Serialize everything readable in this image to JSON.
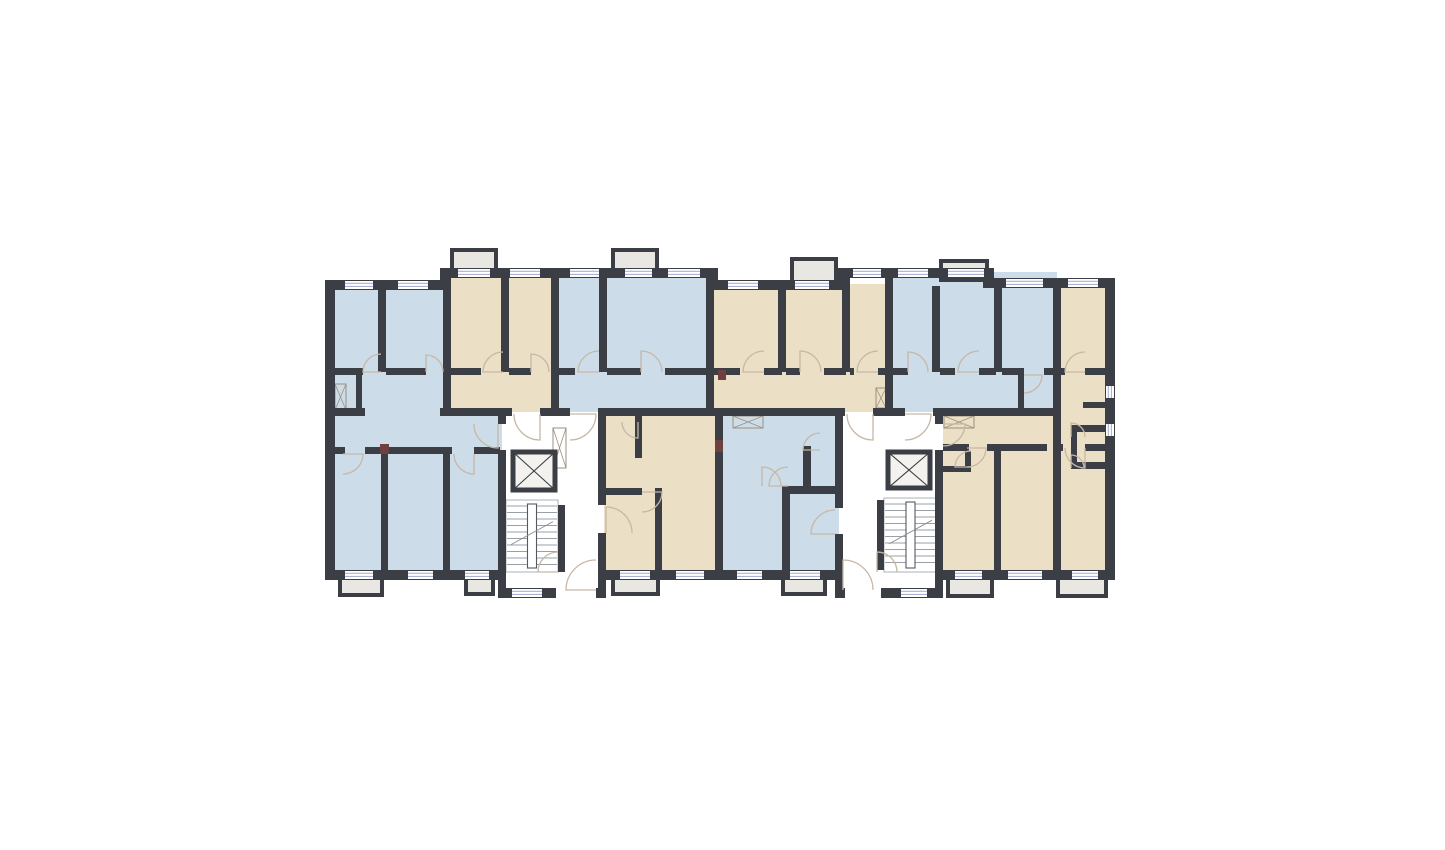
{
  "meta": {
    "type": "architectural-floor-plan",
    "description": "Apartment building floor plan with two stair-elevator cores, blue and beige units, balconies, windows and door swings",
    "canvas": {
      "width": 1445,
      "height": 850,
      "background": "#ffffff"
    }
  },
  "palette": {
    "wall": "#3b3e44",
    "unit_blue": "#cddce9",
    "unit_beige": "#ebdfc6",
    "core_white": "#ffffff",
    "balcony_fill": "#e9e7e1",
    "window_line": "#aab2d6",
    "door_line": "#c6b8a6",
    "stair_line": "#9aa0a8",
    "stair_rail_stroke": "#555a60",
    "hatch_line": "#9a917f",
    "accent_block": "#6e4040",
    "elevator_fill": "#f4f2ee"
  },
  "floor_plan": {
    "view_box": "0 0 1445 850",
    "units": [
      {
        "id": "unit-1",
        "color": "unit_blue",
        "points": "330,285 447,285 447,412 506,412 506,575 330,575"
      },
      {
        "id": "unit-2",
        "color": "unit_beige",
        "points": "447,272 555,272 555,412 447,412"
      },
      {
        "id": "unit-3",
        "color": "unit_blue",
        "points": "555,272 710,272 710,412 555,412"
      },
      {
        "id": "unit-4",
        "color": "unit_beige",
        "points": "710,284 889,284 889,412 710,412"
      },
      {
        "id": "unit-5",
        "color": "unit_blue",
        "points": "889,272 1057,272 1057,412 889,412"
      },
      {
        "id": "unit-6",
        "color": "unit_beige",
        "points": "1057,282 1110,282 1110,575 939,575 939,412 1057,412"
      },
      {
        "id": "unit-7",
        "color": "unit_beige",
        "points": "602,412 719,412 719,575 602,575"
      },
      {
        "id": "unit-8",
        "color": "unit_blue",
        "points": "719,412 839,412 839,575 719,575"
      },
      {
        "id": "core-1",
        "color": "core_white",
        "points": "502,412 604,412 604,596 502,596"
      },
      {
        "id": "core-2",
        "color": "core_white",
        "points": "839,412 943,412 943,596 839,596"
      }
    ],
    "balconies": [
      [
        452,
        250,
        44,
        20
      ],
      [
        613,
        250,
        44,
        20
      ],
      [
        792,
        259,
        44,
        23
      ],
      [
        941,
        261,
        46,
        19
      ],
      [
        340,
        578,
        42,
        17
      ],
      [
        466,
        578,
        27,
        16
      ],
      [
        613,
        578,
        45,
        16
      ],
      [
        783,
        578,
        42,
        16
      ],
      [
        948,
        578,
        44,
        18
      ],
      [
        1058,
        578,
        48,
        18
      ]
    ],
    "walls": [
      [
        325,
        280,
        123,
        10
      ],
      [
        443,
        268,
        272,
        10
      ],
      [
        710,
        280,
        133,
        10
      ],
      [
        838,
        268,
        153,
        10
      ],
      [
        986,
        278,
        129,
        10
      ],
      [
        440,
        268,
        11,
        22
      ],
      [
        707,
        268,
        11,
        22
      ],
      [
        835,
        268,
        11,
        22
      ],
      [
        983,
        268,
        11,
        20
      ],
      [
        325,
        280,
        10,
        300
      ],
      [
        1105,
        278,
        10,
        302
      ],
      [
        325,
        570,
        177,
        10
      ],
      [
        604,
        570,
        235,
        10
      ],
      [
        943,
        570,
        162,
        10
      ],
      [
        325,
        408,
        40,
        8
      ],
      [
        440,
        408,
        72,
        8
      ],
      [
        540,
        408,
        30,
        8
      ],
      [
        598,
        408,
        117,
        8
      ],
      [
        715,
        408,
        130,
        8
      ],
      [
        873,
        408,
        32,
        8
      ],
      [
        933,
        408,
        120,
        8
      ],
      [
        378,
        288,
        8,
        84
      ],
      [
        443,
        268,
        8,
        148
      ],
      [
        501,
        276,
        8,
        96
      ],
      [
        551,
        268,
        8,
        148
      ],
      [
        599,
        276,
        8,
        96
      ],
      [
        706,
        268,
        8,
        148
      ],
      [
        778,
        288,
        8,
        84
      ],
      [
        842,
        276,
        8,
        96
      ],
      [
        885,
        268,
        8,
        148
      ],
      [
        932,
        286,
        8,
        86
      ],
      [
        994,
        286,
        8,
        86
      ],
      [
        1053,
        278,
        8,
        292
      ],
      [
        335,
        368,
        28,
        7
      ],
      [
        386,
        368,
        40,
        7
      ],
      [
        451,
        368,
        30,
        7
      ],
      [
        509,
        368,
        22,
        7
      ],
      [
        559,
        368,
        16,
        7
      ],
      [
        607,
        368,
        34,
        7
      ],
      [
        665,
        368,
        45,
        7
      ],
      [
        714,
        368,
        26,
        7
      ],
      [
        764,
        368,
        18,
        7
      ],
      [
        786,
        368,
        14,
        7
      ],
      [
        824,
        368,
        22,
        7
      ],
      [
        850,
        368,
        4,
        7
      ],
      [
        878,
        368,
        9,
        7
      ],
      [
        893,
        368,
        15,
        7
      ],
      [
        940,
        368,
        15,
        7
      ],
      [
        979,
        368,
        17,
        7
      ],
      [
        1002,
        368,
        22,
        7
      ],
      [
        1044,
        368,
        9,
        7
      ],
      [
        1018,
        368,
        6,
        40
      ],
      [
        1061,
        368,
        4,
        7
      ],
      [
        1085,
        368,
        20,
        7
      ],
      [
        1083,
        402,
        22,
        6
      ],
      [
        1071,
        425,
        34,
        7
      ],
      [
        1071,
        462,
        34,
        7
      ],
      [
        1071,
        432,
        6,
        30
      ],
      [
        356,
        374,
        6,
        36
      ],
      [
        335,
        447,
        10,
        7
      ],
      [
        365,
        447,
        87,
        7
      ],
      [
        474,
        447,
        26,
        7
      ],
      [
        381,
        454,
        7,
        118
      ],
      [
        443,
        454,
        7,
        118
      ],
      [
        498,
        416,
        8,
        8
      ],
      [
        498,
        450,
        8,
        148
      ],
      [
        598,
        416,
        8,
        89
      ],
      [
        598,
        533,
        8,
        65
      ],
      [
        558,
        505,
        7,
        67
      ],
      [
        498,
        588,
        58,
        10
      ],
      [
        596,
        588,
        10,
        10
      ],
      [
        835,
        416,
        8,
        92
      ],
      [
        835,
        534,
        8,
        64
      ],
      [
        935,
        416,
        8,
        8
      ],
      [
        935,
        450,
        8,
        148
      ],
      [
        877,
        500,
        7,
        70
      ],
      [
        835,
        588,
        10,
        10
      ],
      [
        881,
        588,
        62,
        10
      ],
      [
        635,
        416,
        7,
        42
      ],
      [
        606,
        488,
        36,
        7
      ],
      [
        655,
        488,
        7,
        84
      ],
      [
        715,
        416,
        8,
        154
      ],
      [
        803,
        446,
        8,
        42
      ],
      [
        782,
        486,
        57,
        8
      ],
      [
        782,
        486,
        8,
        84
      ],
      [
        943,
        444,
        26,
        7
      ],
      [
        987,
        444,
        60,
        7
      ],
      [
        1053,
        444,
        10,
        7
      ],
      [
        1085,
        444,
        20,
        7
      ],
      [
        965,
        451,
        6,
        18
      ],
      [
        943,
        466,
        28,
        6
      ],
      [
        994,
        451,
        7,
        119
      ]
    ],
    "windows": [
      [
        345,
        281,
        28,
        8,
        0
      ],
      [
        398,
        281,
        30,
        8,
        0
      ],
      [
        458,
        269,
        32,
        8,
        0
      ],
      [
        510,
        269,
        30,
        8,
        0
      ],
      [
        570,
        269,
        29,
        8,
        0
      ],
      [
        625,
        269,
        27,
        8,
        0
      ],
      [
        668,
        269,
        32,
        8,
        0
      ],
      [
        728,
        281,
        30,
        8,
        0
      ],
      [
        795,
        281,
        34,
        8,
        0
      ],
      [
        853,
        269,
        28,
        8,
        0
      ],
      [
        898,
        269,
        30,
        8,
        0
      ],
      [
        948,
        269,
        36,
        8,
        0
      ],
      [
        1006,
        279,
        37,
        8,
        0
      ],
      [
        1068,
        279,
        30,
        8,
        0
      ],
      [
        345,
        571,
        28,
        8,
        0
      ],
      [
        408,
        571,
        25,
        8,
        0
      ],
      [
        465,
        571,
        24,
        8,
        0
      ],
      [
        620,
        571,
        30,
        8,
        0
      ],
      [
        676,
        571,
        28,
        8,
        0
      ],
      [
        737,
        571,
        25,
        8,
        0
      ],
      [
        790,
        571,
        30,
        8,
        0
      ],
      [
        955,
        571,
        27,
        8,
        0
      ],
      [
        1008,
        571,
        34,
        8,
        0
      ],
      [
        1072,
        571,
        26,
        8,
        0
      ],
      [
        512,
        589,
        30,
        8,
        0
      ],
      [
        901,
        589,
        26,
        8,
        0
      ],
      [
        1106,
        386,
        8,
        12,
        1
      ],
      [
        1106,
        424,
        8,
        12,
        1
      ]
    ],
    "doors": [
      [
        381,
        372,
        18,
        180,
        270,
        1
      ],
      [
        426,
        372,
        17,
        270,
        360,
        1
      ],
      [
        503,
        372,
        20,
        180,
        270,
        1
      ],
      [
        531,
        372,
        18,
        270,
        360,
        1
      ],
      [
        599,
        372,
        21,
        180,
        270,
        1
      ],
      [
        641,
        372,
        21,
        270,
        360,
        1
      ],
      [
        764,
        372,
        21,
        180,
        270,
        1
      ],
      [
        800,
        372,
        21,
        270,
        360,
        1
      ],
      [
        878,
        372,
        21,
        180,
        270,
        1
      ],
      [
        908,
        372,
        20,
        270,
        360,
        1
      ],
      [
        979,
        372,
        21,
        180,
        270,
        1
      ],
      [
        1024,
        375,
        18,
        0,
        90,
        1
      ],
      [
        1085,
        372,
        20,
        180,
        270,
        1
      ],
      [
        1071,
        437,
        14,
        270,
        360,
        1
      ],
      [
        1071,
        468,
        13,
        270,
        360,
        1
      ],
      [
        540,
        414,
        26,
        90,
        180,
        1
      ],
      [
        570,
        414,
        26,
        0,
        90,
        1
      ],
      [
        498,
        424,
        24,
        90,
        180,
        1
      ],
      [
        606,
        533,
        26,
        270,
        360,
        1
      ],
      [
        558,
        572,
        20,
        180,
        270,
        1
      ],
      [
        596,
        590,
        30,
        180,
        270,
        1
      ],
      [
        873,
        414,
        26,
        90,
        180,
        1
      ],
      [
        905,
        414,
        26,
        0,
        90,
        1
      ],
      [
        835,
        534,
        24,
        180,
        270,
        1
      ],
      [
        943,
        424,
        22,
        0,
        90,
        1
      ],
      [
        877,
        572,
        20,
        270,
        360,
        1
      ],
      [
        843,
        590,
        30,
        270,
        360,
        1
      ],
      [
        343,
        454,
        20,
        0,
        90,
        1
      ],
      [
        474,
        454,
        20,
        90,
        180,
        1
      ],
      [
        642,
        492,
        20,
        0,
        90,
        1
      ],
      [
        638,
        422,
        16,
        90,
        180,
        1
      ],
      [
        762,
        486,
        19,
        270,
        360,
        1
      ],
      [
        788,
        486,
        19,
        180,
        270,
        1
      ],
      [
        820,
        450,
        17,
        180,
        270,
        1
      ],
      [
        971,
        467,
        16,
        180,
        270,
        1
      ],
      [
        967,
        448,
        19,
        0,
        90,
        1
      ],
      [
        1085,
        448,
        20,
        90,
        180,
        1
      ]
    ],
    "elevators": [
      [
        513,
        452,
        42,
        38
      ],
      [
        888,
        452,
        42,
        36
      ]
    ],
    "stairs": [
      [
        506,
        500,
        52,
        72
      ],
      [
        884,
        498,
        53,
        74
      ]
    ],
    "wardrobes": [
      [
        733,
        416,
        30,
        12
      ],
      [
        944,
        416,
        30,
        12
      ],
      [
        335,
        384,
        11,
        26
      ],
      [
        876,
        388,
        10,
        20
      ],
      [
        553,
        428,
        13,
        40
      ]
    ],
    "accents": [
      [
        715,
        440,
        8,
        12
      ],
      [
        380,
        444,
        9,
        10
      ],
      [
        718,
        370,
        8,
        10
      ]
    ]
  }
}
